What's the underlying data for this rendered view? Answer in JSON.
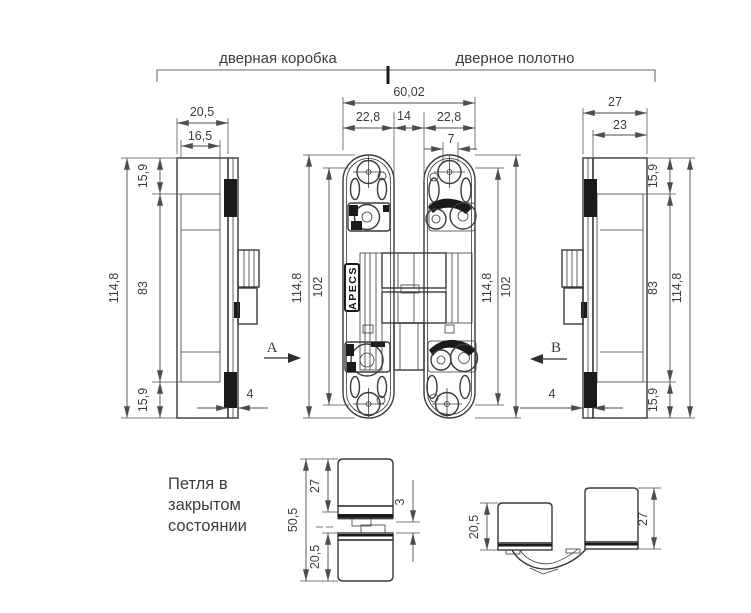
{
  "header": {
    "frame_label": "дверная коробка",
    "leaf_label": "дверное полотно"
  },
  "frame_side_view": {
    "width": "20,5",
    "inner_width": "16,5",
    "top_offset": "15,9",
    "body_height": "83",
    "total_height": "114,8",
    "bottom_offset": "15,9",
    "plate_thickness": "4",
    "section_label": "A"
  },
  "front_view": {
    "total_width": "60,02",
    "left_plate_width": "22,8",
    "center_gap": "14",
    "right_plate_width": "22,8",
    "hole_pitch": "7",
    "left_total_height": "114,8",
    "left_inner_height": "102",
    "right_total_height": "114,8",
    "right_inner_height": "102",
    "brand": "APECS"
  },
  "leaf_side_view": {
    "width": "27",
    "inner_width": "23",
    "top_offset": "15,9",
    "body_height": "83",
    "total_height": "114,8",
    "bottom_offset": "15,9",
    "plate_thickness": "4",
    "section_label": "B"
  },
  "closed_view": {
    "caption": [
      "Петля в",
      "закрытом",
      "состоянии"
    ],
    "total_depth": "50,5",
    "top_depth": "27",
    "gap": "3",
    "bottom_depth": "20,5"
  },
  "open_view": {
    "left_depth": "20,5",
    "right_depth": "27"
  }
}
